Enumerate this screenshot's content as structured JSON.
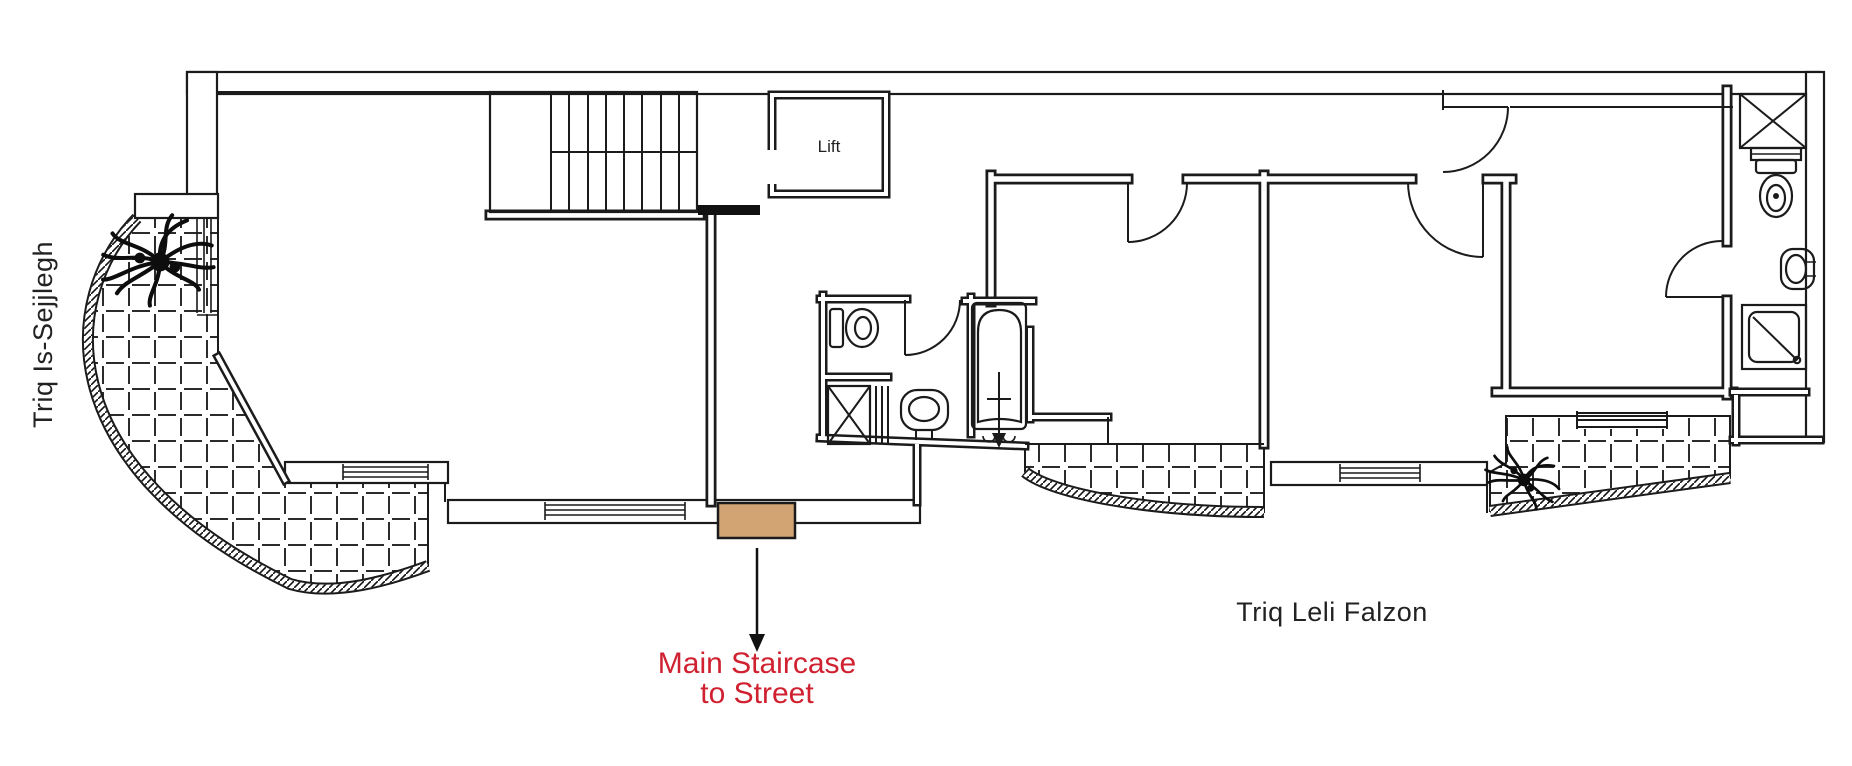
{
  "title": "Apartment floor plan",
  "labels": {
    "lift": "Lift",
    "street_left": "Triq Is-Sejjlegh",
    "street_bottom": "Triq Leli Falzon",
    "annotation_line1": "Main Staircase",
    "annotation_line2": "to Street"
  },
  "colors": {
    "line": "#1b1b1b",
    "annotation_red": "#cf2130",
    "marker_tan": "#d2a474",
    "background": "#ffffff"
  }
}
